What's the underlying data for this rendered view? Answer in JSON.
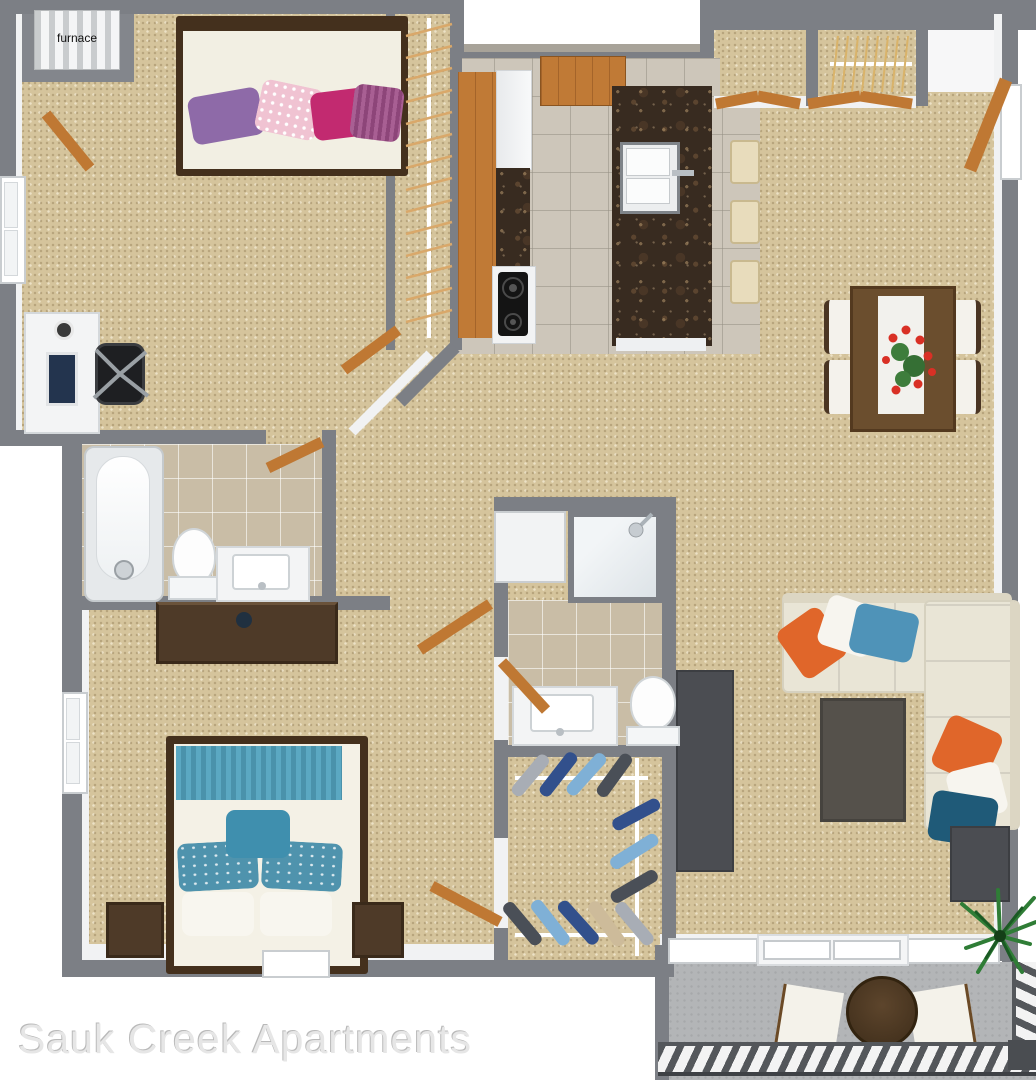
{
  "title": {
    "text": "Sauk Creek Apartments",
    "color": "#e6e6e6"
  },
  "floor_plan": {
    "style": "3d-top-down-apartment-render",
    "labels": {
      "furnace": "furnace"
    },
    "regions": [
      "furnace-closet",
      "bedroom-1",
      "bedroom-1-closet",
      "kitchen",
      "coat-closet",
      "entry-closet",
      "entry",
      "dining-area",
      "living-room",
      "hallway",
      "bathroom-1",
      "bathroom-2",
      "laundry-closet",
      "walk-in-closet",
      "bedroom-2",
      "patio"
    ],
    "colors": {
      "wall": "#7c7f85",
      "carpet": "#d5c49c",
      "kitchen_tile": "#cdc6ba",
      "bath_tile": "#c9bda6",
      "granite": "#382b20",
      "wood_door": "#bf7833",
      "walnut_furniture": "#4a3523",
      "sofa_cream": "#e9e5d6",
      "accent_orange": "#e0662a",
      "accent_blue": "#4f93b8",
      "accent_teal_dark": "#1f5a78",
      "bed2_teal": "#5ba8c2",
      "pillow_purple": "#8e6aa8",
      "pillow_magenta": "#c22a70",
      "pillow_pink": "#f0c3d2",
      "patio_concrete": "#b3b5b7",
      "plant_green": "#2f7d36"
    }
  }
}
